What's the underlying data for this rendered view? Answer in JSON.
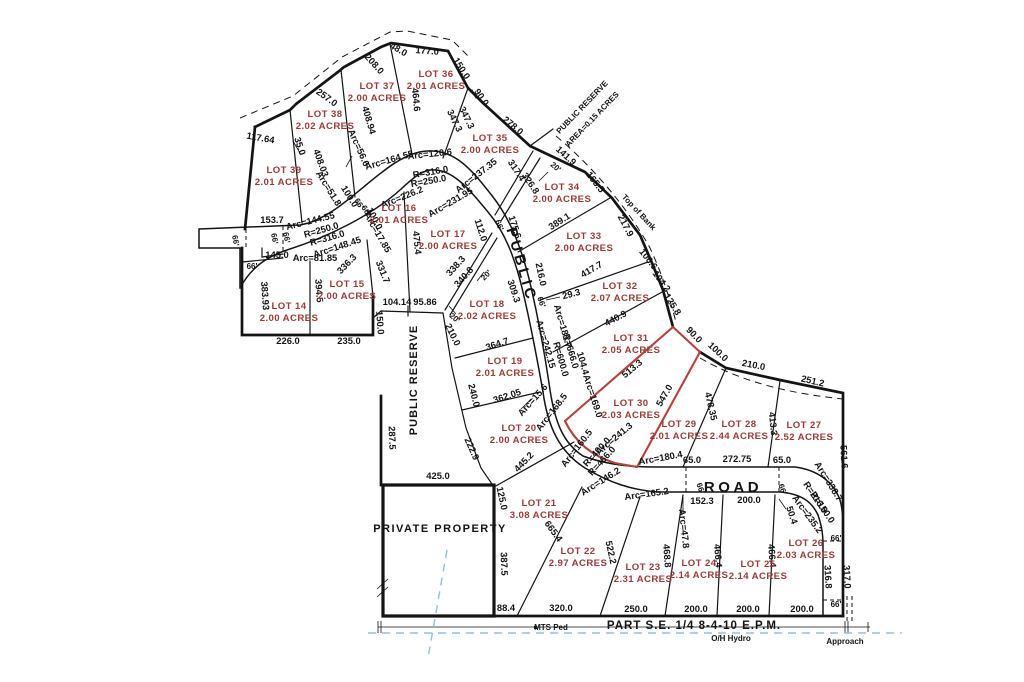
{
  "colors": {
    "lot_text": "#9a3b35",
    "dim_text": "#141414",
    "line": "#141414",
    "red_line": "#b5413c",
    "blue_line": "#8fc1e3",
    "bg": "#ffffff"
  },
  "road_labels": [
    {
      "text": "PUBLIC",
      "x": 517,
      "y": 266,
      "r": 74
    },
    {
      "text": "ROAD",
      "x": 733,
      "y": 492,
      "r": 0
    }
  ],
  "area_labels": [
    {
      "text": "PUBLIC RESERVE",
      "x": 584,
      "y": 109,
      "r": -46,
      "cls": "sm"
    },
    {
      "text": "AREA=0.15 ACRES",
      "x": 594,
      "y": 121,
      "r": -46,
      "cls": "sm"
    },
    {
      "text": "PUBLIC RESERVE",
      "x": 417,
      "y": 380,
      "r": -90,
      "cls": "reserve"
    },
    {
      "text": "Top of Bank",
      "x": 637,
      "y": 214,
      "r": 47,
      "cls": "sm"
    },
    {
      "text": "PRIVATE PROPERTY",
      "x": 440,
      "y": 532,
      "r": 0,
      "cls": "bigname"
    }
  ],
  "footer_labels": [
    {
      "text": "PART S.E. 1/4 8-4-10 E.P.M.",
      "x": 694,
      "y": 629,
      "r": 0,
      "cls": "footer"
    },
    {
      "text": "O/H Hydro",
      "x": 731,
      "y": 641,
      "r": 0,
      "cls": "sm"
    },
    {
      "text": "Approach",
      "x": 845,
      "y": 644,
      "r": 0,
      "cls": "sm"
    },
    {
      "text": "MTS Ped",
      "x": 551,
      "y": 630,
      "r": 0,
      "cls": "sm"
    }
  ],
  "lots": [
    {
      "name": "LOT 14",
      "acres": "2.00 ACRES",
      "x": 289,
      "y": 313
    },
    {
      "name": "LOT 15",
      "acres": "2.00 ACRES",
      "x": 347,
      "y": 291
    },
    {
      "name": "LOT 16",
      "acres": "2.01 ACRES",
      "x": 399,
      "y": 215
    },
    {
      "name": "LOT 17",
      "acres": "2.00 ACRES",
      "x": 448,
      "y": 241
    },
    {
      "name": "LOT 18",
      "acres": "2.02 ACRES",
      "x": 487,
      "y": 311
    },
    {
      "name": "LOT 19",
      "acres": "2.01 ACRES",
      "x": 505,
      "y": 368
    },
    {
      "name": "LOT 20",
      "acres": "2.00 ACRES",
      "x": 519,
      "y": 435
    },
    {
      "name": "LOT 21",
      "acres": "3.08 ACRES",
      "x": 539,
      "y": 510
    },
    {
      "name": "LOT 22",
      "acres": "2.97 ACRES",
      "x": 578,
      "y": 558
    },
    {
      "name": "LOT 23",
      "acres": "2.31 ACRES",
      "x": 643,
      "y": 574
    },
    {
      "name": "LOT 24",
      "acres": "2.14 ACRES",
      "x": 699,
      "y": 570
    },
    {
      "name": "LOT 25",
      "acres": "2.14 ACRES",
      "x": 758,
      "y": 571
    },
    {
      "name": "LOT 26",
      "acres": "2.03 ACRES",
      "x": 806,
      "y": 550
    },
    {
      "name": "LOT 27",
      "acres": "2.52 ACRES",
      "x": 804,
      "y": 432
    },
    {
      "name": "LOT 28",
      "acres": "2.44 ACRES",
      "x": 739,
      "y": 431
    },
    {
      "name": "LOT 29",
      "acres": "2.01 ACRES",
      "x": 679,
      "y": 431
    },
    {
      "name": "LOT 30",
      "acres": "2.03 ACRES",
      "x": 631,
      "y": 410
    },
    {
      "name": "LOT 31",
      "acres": "2.05 ACRES",
      "x": 631,
      "y": 345
    },
    {
      "name": "LOT 32",
      "acres": "2.07 ACRES",
      "x": 620,
      "y": 293
    },
    {
      "name": "LOT 33",
      "acres": "2.00 ACRES",
      "x": 584,
      "y": 243
    },
    {
      "name": "LOT 34",
      "acres": "2.00 ACRES",
      "x": 562,
      "y": 194
    },
    {
      "name": "LOT 35",
      "acres": "2.00 ACRES",
      "x": 490,
      "y": 145
    },
    {
      "name": "LOT 36",
      "acres": "2.01 ACRES",
      "x": 436,
      "y": 81
    },
    {
      "name": "LOT 37",
      "acres": "2.00 ACRES",
      "x": 377,
      "y": 93
    },
    {
      "name": "LOT 38",
      "acres": "2.02 ACRES",
      "x": 325,
      "y": 121
    },
    {
      "name": "LOT 39",
      "acres": "2.01 ACRES",
      "x": 284,
      "y": 177
    }
  ],
  "dimensions": [
    {
      "t": "48.0",
      "x": 397,
      "y": 52,
      "r": 30
    },
    {
      "t": "177.0",
      "x": 427,
      "y": 54,
      "r": 4
    },
    {
      "t": "208.0",
      "x": 372,
      "y": 66,
      "r": 48
    },
    {
      "t": "150.0",
      "x": 459,
      "y": 70,
      "r": 58
    },
    {
      "t": "257.0",
      "x": 325,
      "y": 100,
      "r": 36
    },
    {
      "t": "464.6",
      "x": 413,
      "y": 100,
      "r": 84
    },
    {
      "t": "90.0",
      "x": 479,
      "y": 99,
      "r": 55
    },
    {
      "t": "347.3",
      "x": 452,
      "y": 122,
      "r": 64
    },
    {
      "t": "347.3",
      "x": 464,
      "y": 119,
      "r": 64
    },
    {
      "t": "278.0",
      "x": 511,
      "y": 128,
      "r": 40
    },
    {
      "t": "117.64",
      "x": 260,
      "y": 141,
      "r": 10
    },
    {
      "t": "35.0",
      "x": 297,
      "y": 147,
      "r": 72
    },
    {
      "t": "408.03",
      "x": 318,
      "y": 164,
      "r": 70
    },
    {
      "t": "408.94",
      "x": 366,
      "y": 121,
      "r": 74
    },
    {
      "t": "Arc=56.6",
      "x": 356,
      "y": 149,
      "r": 66
    },
    {
      "t": "Arc=164.55",
      "x": 390,
      "y": 163,
      "r": -16
    },
    {
      "t": "Arc=120.6",
      "x": 430,
      "y": 157,
      "r": -6
    },
    {
      "t": "R=316.0",
      "x": 431,
      "y": 175,
      "r": -10
    },
    {
      "t": "R=250.0",
      "x": 429,
      "y": 184,
      "r": -10
    },
    {
      "t": "Arc=237.35",
      "x": 478,
      "y": 178,
      "r": -38
    },
    {
      "t": "Arc=226.2",
      "x": 403,
      "y": 200,
      "r": -22
    },
    {
      "t": "Arc=231.95",
      "x": 452,
      "y": 205,
      "r": -30
    },
    {
      "t": "Arc=51.8",
      "x": 326,
      "y": 190,
      "r": 58
    },
    {
      "t": "100.0",
      "x": 347,
      "y": 198,
      "r": 58
    },
    {
      "t": "66'",
      "x": 357,
      "y": 205,
      "r": 58
    },
    {
      "t": "66'",
      "x": 364,
      "y": 212,
      "r": 58
    },
    {
      "t": "100.0",
      "x": 372,
      "y": 220,
      "r": 62
    },
    {
      "t": "Arc=17.85",
      "x": 375,
      "y": 234,
      "r": 60
    },
    {
      "t": "Arc=144.55",
      "x": 311,
      "y": 224,
      "r": -14
    },
    {
      "t": "R=250.0",
      "x": 322,
      "y": 233,
      "r": -16
    },
    {
      "t": "R=316.0",
      "x": 328,
      "y": 241,
      "r": -16
    },
    {
      "t": "Arc=148.45",
      "x": 338,
      "y": 250,
      "r": -18
    },
    {
      "t": "Arc=81.85",
      "x": 315,
      "y": 261,
      "r": 0
    },
    {
      "t": "153.7",
      "x": 272,
      "y": 223,
      "r": 0
    },
    {
      "t": "66'",
      "x": 233,
      "y": 241,
      "r": 80
    },
    {
      "t": "66'",
      "x": 272,
      "y": 239,
      "r": 80
    },
    {
      "t": "66'",
      "x": 284,
      "y": 238,
      "r": 80
    },
    {
      "t": "145.0",
      "x": 277,
      "y": 258,
      "r": 0
    },
    {
      "t": "66'",
      "x": 252,
      "y": 269,
      "r": 0
    },
    {
      "t": "383.93",
      "x": 262,
      "y": 296,
      "r": 86
    },
    {
      "t": "394.5",
      "x": 316,
      "y": 291,
      "r": 86
    },
    {
      "t": "226.0",
      "x": 288,
      "y": 344,
      "r": 0
    },
    {
      "t": "235.0",
      "x": 349,
      "y": 344,
      "r": 0
    },
    {
      "t": "150.0",
      "x": 377,
      "y": 323,
      "r": 86
    },
    {
      "t": "104.14",
      "x": 397,
      "y": 305,
      "r": 0
    },
    {
      "t": "95.86",
      "x": 425,
      "y": 305,
      "r": 0
    },
    {
      "t": "331.7",
      "x": 380,
      "y": 273,
      "r": 68
    },
    {
      "t": "336.3",
      "x": 349,
      "y": 266,
      "r": -46
    },
    {
      "t": "475.4",
      "x": 414,
      "y": 243,
      "r": 84
    },
    {
      "t": "112.0",
      "x": 478,
      "y": 231,
      "r": 72
    },
    {
      "t": "66'",
      "x": 497,
      "y": 226,
      "r": 70
    },
    {
      "t": "175.6",
      "x": 512,
      "y": 228,
      "r": 72
    },
    {
      "t": "317.4",
      "x": 514,
      "y": 172,
      "r": 56
    },
    {
      "t": "326.8",
      "x": 528,
      "y": 185,
      "r": 56
    },
    {
      "t": "20'",
      "x": 554,
      "y": 169,
      "r": 40
    },
    {
      "t": "141.9",
      "x": 564,
      "y": 158,
      "r": 42
    },
    {
      "t": "165.5",
      "x": 593,
      "y": 184,
      "r": 52
    },
    {
      "t": "389.1",
      "x": 561,
      "y": 224,
      "r": -32
    },
    {
      "t": "217.9",
      "x": 623,
      "y": 227,
      "r": 62
    },
    {
      "t": "338.3",
      "x": 458,
      "y": 268,
      "r": -48
    },
    {
      "t": "340.8",
      "x": 466,
      "y": 279,
      "r": -48
    },
    {
      "t": "20'",
      "x": 488,
      "y": 277,
      "r": -45
    },
    {
      "t": "20'",
      "x": 453,
      "y": 320,
      "r": 40
    },
    {
      "t": "216.0",
      "x": 538,
      "y": 275,
      "r": 78
    },
    {
      "t": "309.3",
      "x": 511,
      "y": 292,
      "r": 72
    },
    {
      "t": "66'",
      "x": 539,
      "y": 303,
      "r": 70
    },
    {
      "t": "29.3",
      "x": 572,
      "y": 297,
      "r": -14
    },
    {
      "t": "417.7",
      "x": 593,
      "y": 272,
      "r": -30
    },
    {
      "t": "106.6",
      "x": 646,
      "y": 261,
      "r": 52
    },
    {
      "t": "104.2",
      "x": 659,
      "y": 283,
      "r": 54
    },
    {
      "t": "125.8",
      "x": 670,
      "y": 306,
      "r": 58
    },
    {
      "t": "440.9",
      "x": 617,
      "y": 321,
      "r": -28
    },
    {
      "t": "Arc=181.7",
      "x": 560,
      "y": 327,
      "r": 74
    },
    {
      "t": "R=666.0",
      "x": 568,
      "y": 352,
      "r": 74
    },
    {
      "t": "R=600.0",
      "x": 558,
      "y": 360,
      "r": 74
    },
    {
      "t": "104.4",
      "x": 580,
      "y": 364,
      "r": 74
    },
    {
      "t": "Arc=169.0",
      "x": 590,
      "y": 397,
      "r": 72
    },
    {
      "t": "Arc=242.15",
      "x": 543,
      "y": 345,
      "r": 74
    },
    {
      "t": "364.7",
      "x": 498,
      "y": 347,
      "r": -18
    },
    {
      "t": "210.0",
      "x": 450,
      "y": 336,
      "r": 64
    },
    {
      "t": "240.0",
      "x": 471,
      "y": 396,
      "r": 76
    },
    {
      "t": "362.05",
      "x": 508,
      "y": 399,
      "r": -18
    },
    {
      "t": "513.3",
      "x": 634,
      "y": 371,
      "r": -40
    },
    {
      "t": "90.0",
      "x": 692,
      "y": 337,
      "r": 46
    },
    {
      "t": "100.0",
      "x": 716,
      "y": 354,
      "r": 43
    },
    {
      "t": "210.0",
      "x": 753,
      "y": 368,
      "r": 11
    },
    {
      "t": "251.2",
      "x": 812,
      "y": 384,
      "r": 13
    },
    {
      "t": "547.0",
      "x": 667,
      "y": 397,
      "r": -60
    },
    {
      "t": "478.35",
      "x": 708,
      "y": 407,
      "r": 77
    },
    {
      "t": "413.3",
      "x": 770,
      "y": 424,
      "r": 84
    },
    {
      "t": "561.6",
      "x": 841,
      "y": 457,
      "r": 87
    },
    {
      "t": "Arc=180.4",
      "x": 661,
      "y": 461,
      "r": -10
    },
    {
      "t": "65.0",
      "x": 692,
      "y": 463,
      "r": 0
    },
    {
      "t": "272.75",
      "x": 737,
      "y": 462,
      "r": 0
    },
    {
      "t": "65.0",
      "x": 782,
      "y": 463,
      "r": 0
    },
    {
      "t": "66'",
      "x": 698,
      "y": 489,
      "r": 72
    },
    {
      "t": "66'",
      "x": 780,
      "y": 490,
      "r": 72
    },
    {
      "t": "152.3",
      "x": 702,
      "y": 504,
      "r": 0
    },
    {
      "t": "200.0",
      "x": 749,
      "y": 503,
      "r": 0
    },
    {
      "t": "Arc=338.7",
      "x": 826,
      "y": 483,
      "r": 58
    },
    {
      "t": "R=216.0",
      "x": 813,
      "y": 499,
      "r": 56
    },
    {
      "t": "R=150.0",
      "x": 820,
      "y": 509,
      "r": 56
    },
    {
      "t": "Arc=235.2",
      "x": 805,
      "y": 516,
      "r": 54
    },
    {
      "t": "50.4",
      "x": 789,
      "y": 516,
      "r": 72
    },
    {
      "t": "Arc=47.8",
      "x": 681,
      "y": 529,
      "r": 84
    },
    {
      "t": "66'",
      "x": 836,
      "y": 541,
      "r": 0
    },
    {
      "t": "66'",
      "x": 836,
      "y": 607,
      "r": 0
    },
    {
      "t": "317.0",
      "x": 844,
      "y": 577,
      "r": 87
    },
    {
      "t": "316.8",
      "x": 825,
      "y": 577,
      "r": 87
    },
    {
      "t": "466.4",
      "x": 769,
      "y": 556,
      "r": 86
    },
    {
      "t": "466.4",
      "x": 715,
      "y": 556,
      "r": 86
    },
    {
      "t": "468.8",
      "x": 664,
      "y": 556,
      "r": 86
    },
    {
      "t": "522.2",
      "x": 608,
      "y": 553,
      "r": 78
    },
    {
      "t": "665.4",
      "x": 551,
      "y": 533,
      "r": 54
    },
    {
      "t": "Arc=146.2",
      "x": 602,
      "y": 484,
      "r": -32
    },
    {
      "t": "Arc=165.2",
      "x": 647,
      "y": 497,
      "r": -8
    },
    {
      "t": "Arc=160.5",
      "x": 579,
      "y": 450,
      "r": -52
    },
    {
      "t": "R=400.0",
      "x": 599,
      "y": 454,
      "r": -48
    },
    {
      "t": "R=466.0",
      "x": 604,
      "y": 463,
      "r": -48
    },
    {
      "t": "Arc=241.3",
      "x": 616,
      "y": 441,
      "r": -40
    },
    {
      "t": "Arc=168.5",
      "x": 554,
      "y": 414,
      "r": -52
    },
    {
      "t": "Arc=15.6",
      "x": 535,
      "y": 402,
      "r": -48
    },
    {
      "t": "445.2",
      "x": 526,
      "y": 464,
      "r": -46
    },
    {
      "t": "222.9",
      "x": 469,
      "y": 450,
      "r": 66
    },
    {
      "t": "125.0",
      "x": 499,
      "y": 499,
      "r": 78
    },
    {
      "t": "287.5",
      "x": 389,
      "y": 438,
      "r": 88
    },
    {
      "t": "425.0",
      "x": 438,
      "y": 479,
      "r": 0
    },
    {
      "t": "387.5",
      "x": 501,
      "y": 564,
      "r": 88
    },
    {
      "t": "88.4",
      "x": 506,
      "y": 611,
      "r": 0
    },
    {
      "t": "320.0",
      "x": 561,
      "y": 611,
      "r": 0
    },
    {
      "t": "250.0",
      "x": 636,
      "y": 612,
      "r": 0
    },
    {
      "t": "200.0",
      "x": 696,
      "y": 612,
      "r": 0
    },
    {
      "t": "200.0",
      "x": 748,
      "y": 612,
      "r": 0
    },
    {
      "t": "200.0",
      "x": 802,
      "y": 612,
      "r": 0
    }
  ]
}
